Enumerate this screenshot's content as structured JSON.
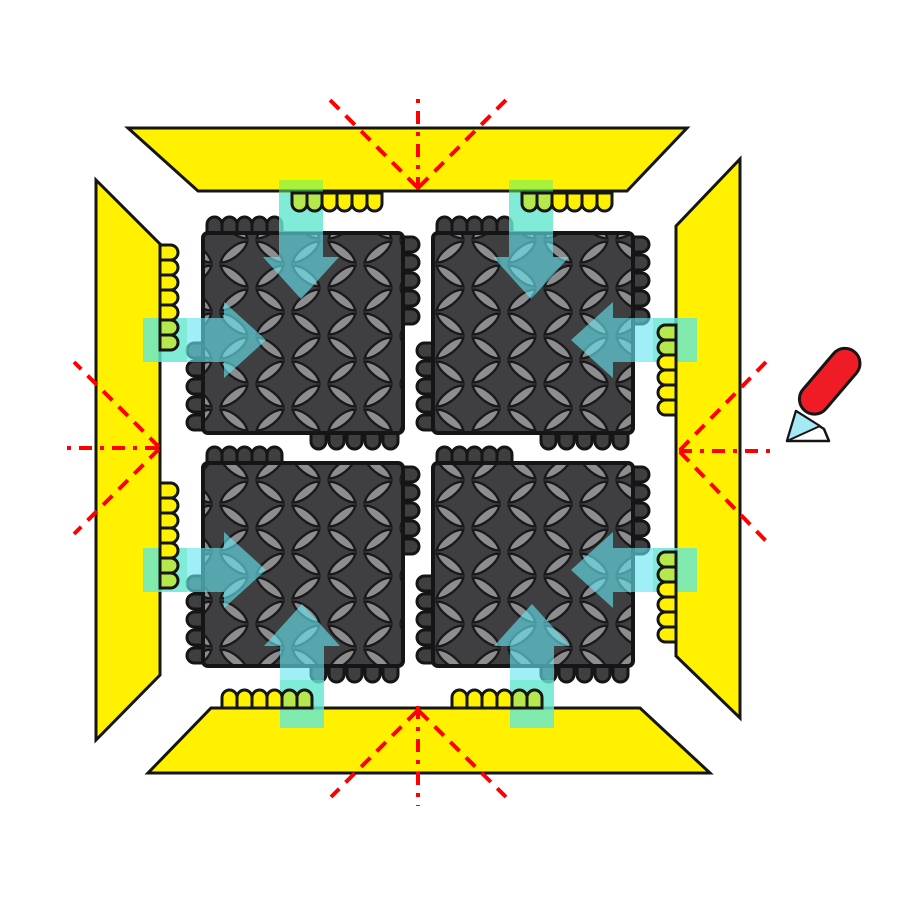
{
  "diagram": {
    "name": "modular-mat-assembly-diagram",
    "canvas": {
      "width": 900,
      "height": 900,
      "background": "#FFFFFF"
    },
    "colors": {
      "ramp_yellow": "#FFF100",
      "outline": "#151515",
      "tile_base": "#3F3F41",
      "lens_fill": "#8D8D8F",
      "lens_stroke": "#19191B",
      "bump_green": "#B5E84C",
      "tab_green": "rgba(96,240,112,0.55)",
      "arrow_cyan": "rgba(104,229,240,0.62)",
      "cut_red": "#FF0000",
      "knife_red": "#EF1C26",
      "blade_cyan": "#A5EAF3",
      "blade_white": "#FFFFFF"
    },
    "pattern": {
      "cell_w": 72,
      "cell_h": 48,
      "lens_path": "M -17 0 C -9 -6.5 9 -6.5 17 0 C 9 6.5 -9 6.5 -17 0 Z",
      "lenses": [
        [
          18,
          12,
          -38
        ],
        [
          54,
          12,
          38
        ],
        [
          18,
          36,
          38
        ],
        [
          54,
          36,
          -38
        ]
      ]
    },
    "ramps": [
      {
        "name": "ramp-top",
        "points": [
          [
            128,
            128
          ],
          [
            687,
            128
          ],
          [
            627,
            191
          ],
          [
            198,
            191
          ]
        ]
      },
      {
        "name": "ramp-left",
        "points": [
          [
            96,
            180
          ],
          [
            160,
            244
          ],
          [
            160,
            675
          ],
          [
            96,
            740
          ]
        ]
      },
      {
        "name": "ramp-bottom",
        "points": [
          [
            211,
            708
          ],
          [
            640,
            708
          ],
          [
            710,
            773
          ],
          [
            148,
            773
          ]
        ]
      },
      {
        "name": "ramp-right",
        "points": [
          [
            676,
            226
          ],
          [
            740,
            159
          ],
          [
            740,
            718
          ],
          [
            676,
            656
          ]
        ]
      }
    ],
    "cut_guides": [
      {
        "name": "cut-guide-top",
        "lines": [
          [
            418,
            190,
            418,
            92,
            "dashdot"
          ],
          [
            417,
            187,
            329,
            99,
            "dash"
          ],
          [
            419,
            187,
            507,
            99,
            "dash"
          ]
        ]
      },
      {
        "name": "cut-guide-bottom",
        "lines": [
          [
            418,
            706,
            418,
            806,
            "dashdot"
          ],
          [
            417,
            711,
            331,
            797,
            "dash"
          ],
          [
            419,
            711,
            506,
            797,
            "dash"
          ]
        ]
      },
      {
        "name": "cut-guide-left",
        "lines": [
          [
            158,
            448,
            66,
            448,
            "dashdot"
          ],
          [
            159,
            447,
            74,
            362,
            "dash"
          ],
          [
            159,
            449,
            74,
            534,
            "dash"
          ]
        ]
      },
      {
        "name": "cut-guide-right",
        "lines": [
          [
            679,
            451,
            772,
            451,
            "dashdot"
          ],
          [
            680,
            450,
            766,
            362,
            "dash"
          ],
          [
            680,
            452,
            766,
            541,
            "dash"
          ]
        ]
      }
    ],
    "tiles": [
      {
        "name": "tile-top-left",
        "x": 203,
        "y": 233,
        "w": 200,
        "h": 200
      },
      {
        "name": "tile-top-right",
        "x": 433,
        "y": 233,
        "w": 200,
        "h": 200
      },
      {
        "name": "tile-bottom-left",
        "x": 203,
        "y": 463,
        "w": 200,
        "h": 203
      },
      {
        "name": "tile-bottom-right",
        "x": 433,
        "y": 463,
        "w": 200,
        "h": 203
      }
    ],
    "tile_bump_layout": {
      "top": [
        4,
        19,
        34,
        49,
        64
      ],
      "right": [
        4,
        22,
        40,
        58,
        76
      ],
      "bottom": [
        108,
        126,
        144,
        162,
        180
      ],
      "left_from_bottom": [
        90,
        72,
        54,
        36,
        18
      ]
    },
    "bump_size": {
      "ramp_w": 15,
      "ramp_h": 18,
      "tile_w": 15,
      "tile_h": 16
    },
    "connector_tabs": [
      {
        "name": "connector-highlight-top-left",
        "x": 279,
        "y": 180,
        "w": 44,
        "h": 52
      },
      {
        "name": "connector-highlight-top-right",
        "x": 509,
        "y": 180,
        "w": 44,
        "h": 52
      },
      {
        "name": "connector-highlight-left-upper",
        "x": 143,
        "y": 318,
        "w": 44,
        "h": 44
      },
      {
        "name": "connector-highlight-left-lower",
        "x": 143,
        "y": 548,
        "w": 44,
        "h": 44
      },
      {
        "name": "connector-highlight-right-upper",
        "x": 653,
        "y": 318,
        "w": 44,
        "h": 44
      },
      {
        "name": "connector-highlight-right-lower",
        "x": 653,
        "y": 548,
        "w": 44,
        "h": 44
      },
      {
        "name": "connector-highlight-bottom-left",
        "x": 280,
        "y": 680,
        "w": 44,
        "h": 48
      },
      {
        "name": "connector-highlight-bottom-right",
        "x": 510,
        "y": 680,
        "w": 44,
        "h": 48
      }
    ],
    "arrows": [
      {
        "name": "assembly-arrow-top-left",
        "tip": [
          301,
          299
        ],
        "rotate": 0,
        "tail": 106
      },
      {
        "name": "assembly-arrow-top-right",
        "tip": [
          531,
          299
        ],
        "rotate": 0,
        "tail": 106
      },
      {
        "name": "assembly-arrow-left-upper",
        "tip": [
          266,
          340
        ],
        "rotate": -90,
        "tail": 123
      },
      {
        "name": "assembly-arrow-left-lower",
        "tip": [
          266,
          570
        ],
        "rotate": -90,
        "tail": 123
      },
      {
        "name": "assembly-arrow-right-upper",
        "tip": [
          571,
          340
        ],
        "rotate": 90,
        "tail": 126
      },
      {
        "name": "assembly-arrow-right-lower",
        "tip": [
          571,
          570
        ],
        "rotate": 90,
        "tail": 126
      },
      {
        "name": "assembly-arrow-bottom-left",
        "tip": [
          302,
          604
        ],
        "rotate": 180,
        "tail": 124
      },
      {
        "name": "assembly-arrow-bottom-right",
        "tip": [
          532,
          604
        ],
        "rotate": 180,
        "tail": 124
      }
    ],
    "arrow_shape": {
      "head_half_width": 38,
      "head_length": 42,
      "tail_half_width": 22
    },
    "ramp_bumps": [
      {
        "name": "ramp-connectors-top-1",
        "dir": "down",
        "edge": 193,
        "green": [
          292,
          307
        ],
        "yellow": [
          322,
          337,
          352,
          367
        ]
      },
      {
        "name": "ramp-connectors-top-2",
        "dir": "down",
        "edge": 193,
        "green": [
          522,
          537
        ],
        "yellow": [
          552,
          567,
          582,
          597
        ]
      },
      {
        "name": "ramp-connectors-bottom-1",
        "dir": "up",
        "edge": 708,
        "yellow": [
          222,
          237,
          252,
          267
        ],
        "green": [
          282,
          297
        ]
      },
      {
        "name": "ramp-connectors-bottom-2",
        "dir": "up",
        "edge": 708,
        "yellow": [
          452,
          467,
          482,
          497
        ],
        "green": [
          512,
          527
        ]
      },
      {
        "name": "ramp-connectors-left-1",
        "dir": "right",
        "edge": 160,
        "yellow": [
          245,
          260,
          275,
          290,
          305
        ],
        "green": [
          320,
          335
        ]
      },
      {
        "name": "ramp-connectors-left-2",
        "dir": "right",
        "edge": 160,
        "yellow": [
          483,
          498,
          513,
          528,
          543
        ],
        "green": [
          558,
          573
        ]
      },
      {
        "name": "ramp-connectors-right-1",
        "dir": "left",
        "edge": 676,
        "green": [
          325,
          340
        ],
        "yellow": [
          355,
          370,
          385,
          400
        ]
      },
      {
        "name": "ramp-connectors-right-2",
        "dir": "left",
        "edge": 676,
        "green": [
          552,
          567
        ],
        "yellow": [
          582,
          597,
          612,
          627
        ]
      }
    ],
    "knife": {
      "name": "utility-knife-icon",
      "blade_points": [
        [
          787,
          441
        ],
        [
          796,
          411
        ],
        [
          824,
          429
        ],
        [
          829,
          441
        ]
      ],
      "blade_edge_points": [
        [
          787,
          441
        ],
        [
          796,
          411
        ],
        [
          820,
          426
        ]
      ],
      "handle": {
        "x": 806,
        "y": 409,
        "rotate": -49.5,
        "length": 77,
        "width": 30
      }
    }
  }
}
